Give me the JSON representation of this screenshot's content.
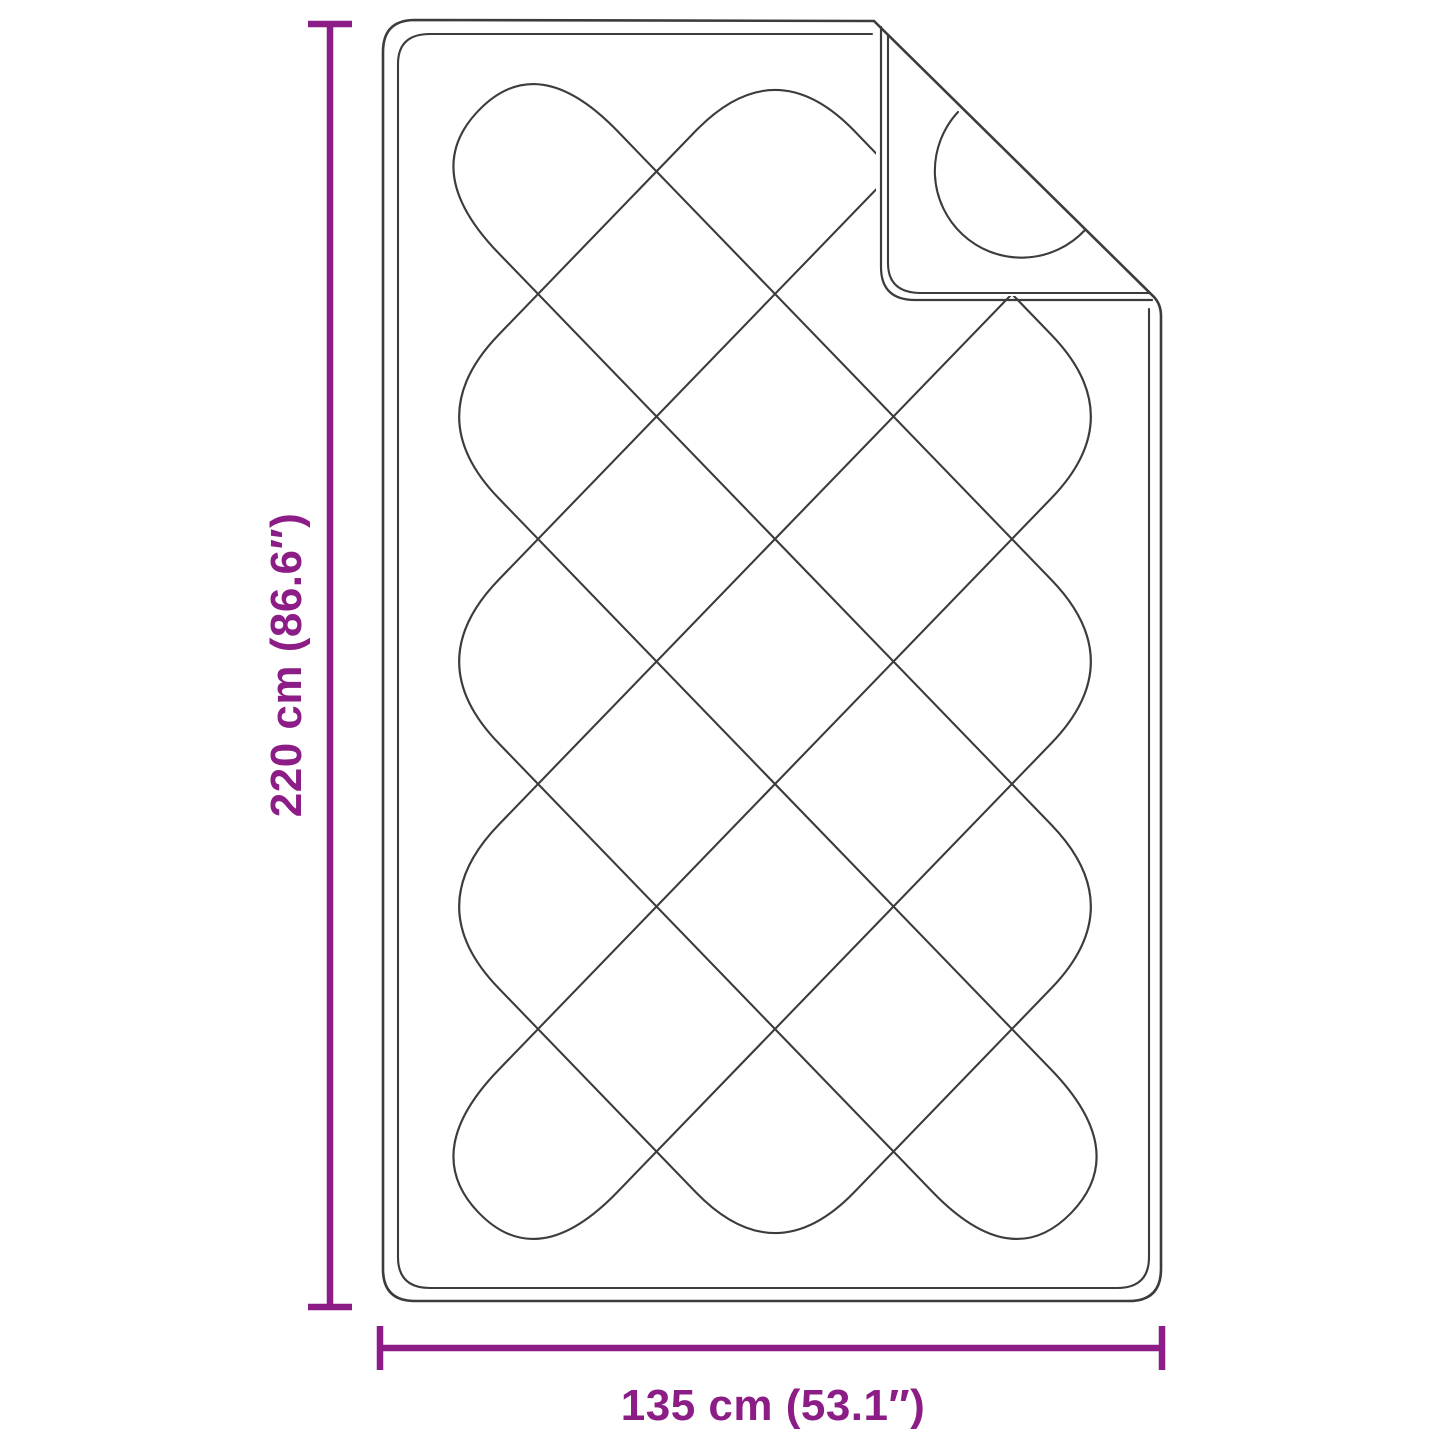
{
  "diagram": {
    "height": {
      "cm": 220,
      "inches": 86.6,
      "label": "220 cm (86.6″)"
    },
    "width": {
      "cm": 135,
      "inches": 53.1,
      "label": "135 cm (53.1″)"
    }
  },
  "colors": {
    "accent": "#8C1D87",
    "line": "#3C3C3C",
    "background": "#FFFFFF"
  }
}
